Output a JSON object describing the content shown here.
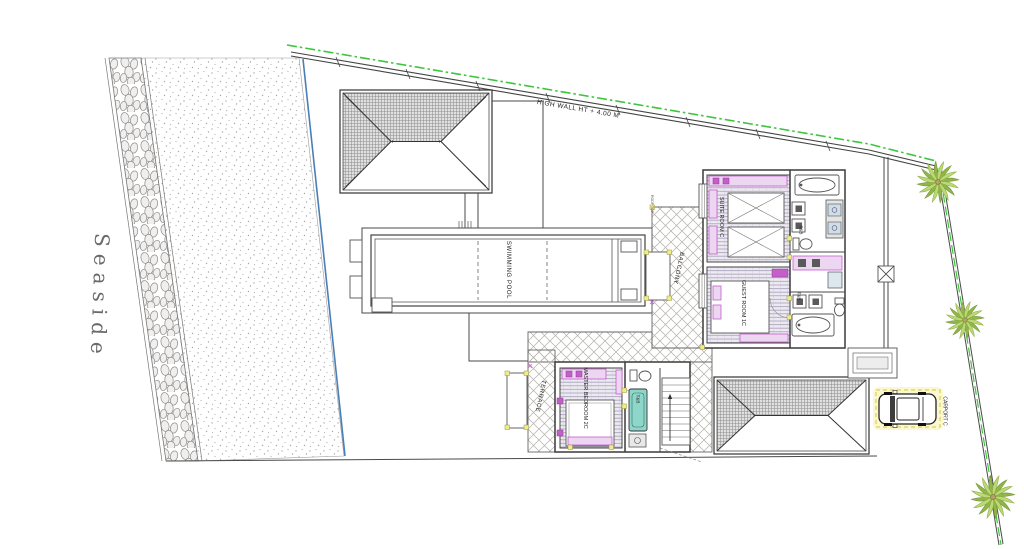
{
  "labels": {
    "seaside": "Seaside",
    "high_wall": "HIGH WALL  HT + 4.00 M",
    "swimming_pool": "SWIMMING POOL",
    "balcony": "BALCONY",
    "terrace": "TERRACE",
    "roof_top": "ROOF TOP",
    "suite_room": "SUITE ROOM C",
    "guest_room": "GUEST ROOM 1C",
    "master_bedroom": "MASTER BEDROOM 2C",
    "suite_tb": "T&B",
    "guest_tb": "T&B",
    "master_tb": "T&B",
    "carport": "CARPORT C"
  },
  "colors": {
    "boundary_green": "#3ec53e",
    "waterline_blue": "#4a7fb5",
    "palm_dark": "#8fb648",
    "palm_light": "#bdd876",
    "palm_trunk": "#b5a066",
    "accent_magenta": "#c45ec8",
    "accent_lavender": "#ecd6f2",
    "tub_teal": "#8fd6ca",
    "marker_yellow": "#f1ec8b",
    "carport_glow": "#fbf7cf"
  }
}
